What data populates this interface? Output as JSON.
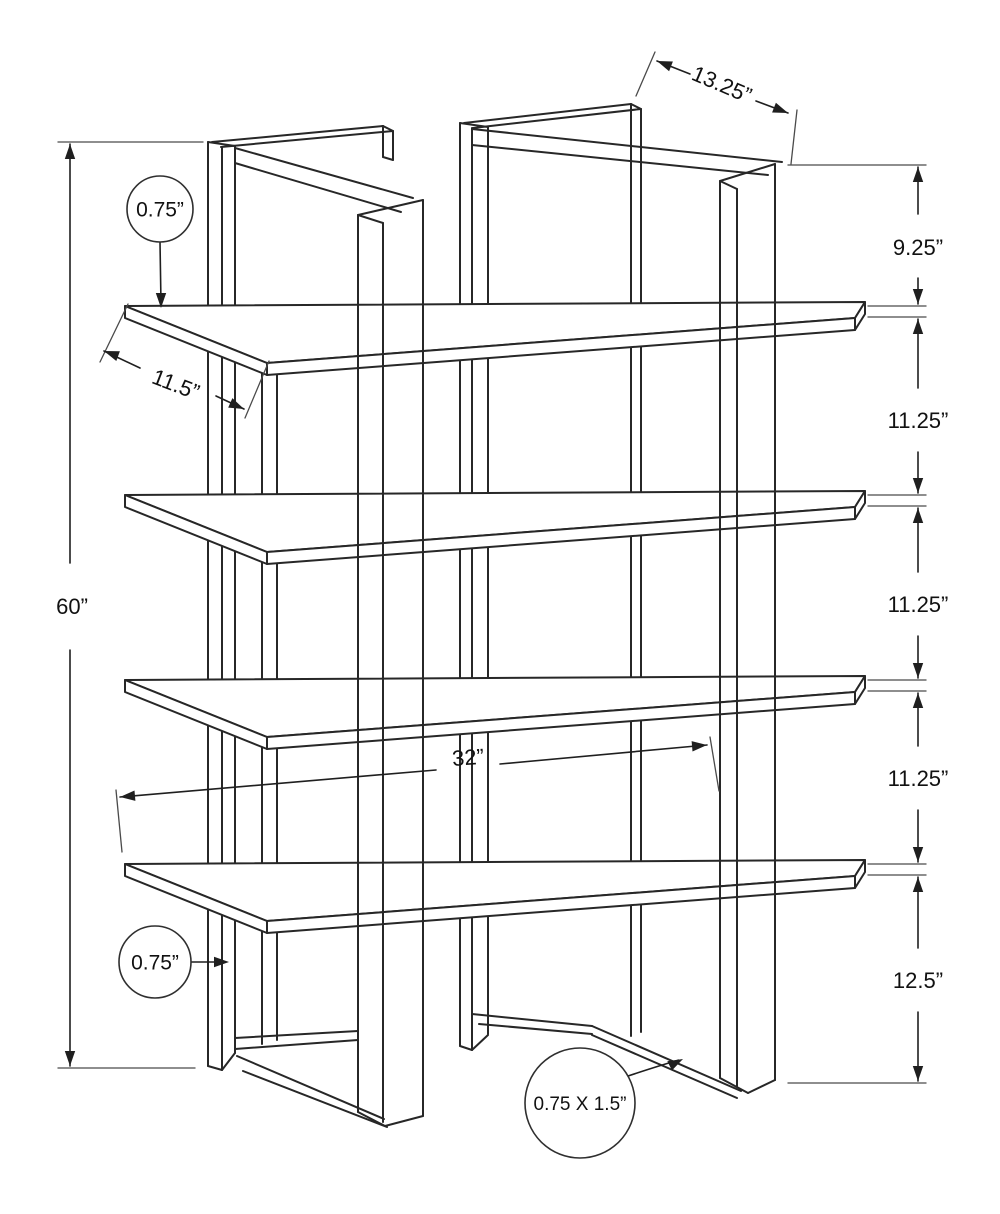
{
  "title": "bookcase-dimension-diagram",
  "labels": {
    "height_total": "60”",
    "top_depth": "13.25”",
    "shelf_depth": "11.5”",
    "width": "32”",
    "gap_top": "9.25”",
    "gap_mid": "11.25”",
    "gap_bottom": "12.5”",
    "shelf_thickness": "0.75”",
    "frame_thickness": "0.75”",
    "tube_size": "0.75 X 1.5”"
  },
  "dimensions_summary": {
    "overall_height": "60”",
    "top_frame_depth": "13.25”",
    "shelf_depth": "11.5”",
    "overall_width": "32”",
    "top_gap": "9.25”",
    "middle_gaps": [
      "11.25”",
      "11.25”",
      "11.25”"
    ],
    "bottom_gap": "12.5”",
    "shelf_thickness": "0.75”",
    "frame_thickness": "0.75”",
    "frame_tube_section": "0.75 X 1.5”"
  },
  "style": {
    "bg": "#ffffff",
    "structure_color": "#272727",
    "dim_color": "#1f1f1f",
    "ext_color": "#4a4a4a",
    "structure_width": 2,
    "dim_width": 1.6,
    "ext_width": 1.3,
    "circle_width": 1.6
  },
  "drawing": {
    "canvas": {
      "w": 1000,
      "h": 1214
    },
    "shelves": {
      "tops": [
        306,
        495,
        680,
        864
      ],
      "x_left": 125,
      "x_right": 865,
      "x_front_left": 267,
      "x_front_right": 855,
      "back_rise": 4,
      "front_left_dy": 57,
      "front_right_dy": 12,
      "thickness_dy": 12
    },
    "far_lines": [
      [
        "left-back-post-outer",
        208,
        142,
        208,
        1066
      ],
      [
        "left-back-post-mid",
        222,
        147,
        222,
        1070
      ],
      [
        "left-back-post-inner",
        235,
        146,
        235,
        1053
      ],
      [
        "left-back-post-topcap",
        208,
        142,
        235,
        146
      ],
      [
        "left-back-post-botcap-a",
        208,
        1066,
        222,
        1070
      ],
      [
        "left-back-post-botcap-b",
        222,
        1070,
        235,
        1053
      ],
      [
        "left-top-band-outer",
        212,
        142,
        383,
        126
      ],
      [
        "left-top-band-inner",
        221,
        147,
        393,
        131
      ],
      [
        "left-top-band-endcap",
        383,
        126,
        393,
        131
      ],
      [
        "left-top-stub-a",
        383,
        126,
        383,
        157
      ],
      [
        "left-top-stub-b",
        393,
        131,
        393,
        160
      ],
      [
        "left-top-stub-bot",
        383,
        157,
        393,
        160
      ],
      [
        "left-mid-bar-a",
        262,
        366,
        262,
        1044
      ],
      [
        "left-mid-bar-b",
        277,
        364,
        277,
        1040
      ],
      [
        "right-back-post-outer",
        460,
        123,
        460,
        1046
      ],
      [
        "right-back-post-mid",
        472,
        128,
        472,
        1050
      ],
      [
        "right-back-post-inner",
        488,
        127,
        488,
        1034
      ],
      [
        "right-back-post-topcap",
        460,
        123,
        488,
        127
      ],
      [
        "right-back-post-botcap-a",
        460,
        1046,
        472,
        1050
      ],
      [
        "right-back-post-botcap-b",
        472,
        1050,
        488,
        1035
      ],
      [
        "right-top-band-outer",
        464,
        123,
        631,
        104
      ],
      [
        "right-top-band-inner",
        473,
        128,
        641,
        109
      ],
      [
        "right-top-band-endcap",
        631,
        104,
        641,
        109
      ],
      [
        "right-stub-bar-a",
        631,
        104,
        631,
        1036
      ],
      [
        "right-stub-bar-b",
        641,
        109,
        641,
        1032
      ]
    ],
    "near_lines": [
      [
        "left-top-rail-top",
        235,
        148,
        413,
        198
      ],
      [
        "left-top-rail-bottom",
        235,
        163,
        401,
        212
      ],
      [
        "left-front-post-outer",
        358,
        215,
        358,
        1112
      ],
      [
        "left-front-post-mid",
        383,
        223,
        383,
        1122
      ],
      [
        "left-front-post-inner",
        423,
        200,
        423,
        1116
      ],
      [
        "left-front-post-topcap-a",
        358,
        215,
        423,
        200
      ],
      [
        "left-front-post-topcap-b",
        358,
        215,
        383,
        223
      ],
      [
        "left-front-post-botcap-a",
        358,
        1112,
        385,
        1126
      ],
      [
        "left-front-post-botcap-b",
        385,
        1126,
        423,
        1116
      ],
      [
        "left-bottom-rail-far-a",
        235,
        1038,
        358,
        1031
      ],
      [
        "left-bottom-rail-far-b",
        235,
        1049,
        358,
        1040
      ],
      [
        "left-bottom-rail-near-a",
        237,
        1056,
        384,
        1119
      ],
      [
        "left-bottom-rail-near-b",
        243,
        1071,
        387,
        1127
      ],
      [
        "right-top-rail-top",
        472,
        129,
        782,
        162
      ],
      [
        "right-top-rail-bottom",
        472,
        145,
        768,
        175
      ],
      [
        "right-front-post-outer",
        720,
        181,
        720,
        1078
      ],
      [
        "right-front-post-mid",
        737,
        189,
        737,
        1087
      ],
      [
        "right-front-post-inner",
        775,
        164,
        775,
        1080
      ],
      [
        "right-front-post-topcap-a",
        720,
        181,
        775,
        164
      ],
      [
        "right-front-post-topcap-b",
        720,
        181,
        737,
        189
      ],
      [
        "right-front-post-botcap-a",
        720,
        1078,
        748,
        1093
      ],
      [
        "right-front-post-botcap-b",
        748,
        1093,
        775,
        1080
      ],
      [
        "right-bottom-rail-far-a",
        472,
        1014,
        592,
        1026
      ],
      [
        "right-bottom-rail-far-b",
        479,
        1024,
        592,
        1034
      ],
      [
        "right-bottom-rail-near-a",
        592,
        1026,
        741,
        1091
      ],
      [
        "right-bottom-rail-near-b",
        592,
        1035,
        737,
        1098
      ]
    ],
    "ext_lines": [
      [
        "ext-height-top",
        58,
        142,
        203,
        142
      ],
      [
        "ext-height-bottom",
        58,
        1068,
        195,
        1068
      ],
      [
        "ext-right-top",
        788,
        165,
        926,
        165
      ],
      [
        "ext-shelf1-top",
        868,
        306,
        926,
        306
      ],
      [
        "ext-shelf1-bottom",
        868,
        317,
        926,
        317
      ],
      [
        "ext-shelf2-top",
        868,
        495,
        926,
        495
      ],
      [
        "ext-shelf2-bottom",
        868,
        506,
        926,
        506
      ],
      [
        "ext-shelf3-top",
        868,
        680,
        926,
        680
      ],
      [
        "ext-shelf3-bottom",
        868,
        691,
        926,
        691
      ],
      [
        "ext-shelf4-top",
        868,
        864,
        926,
        864
      ],
      [
        "ext-shelf4-bottom",
        868,
        875,
        926,
        875
      ],
      [
        "ext-floor",
        788,
        1083,
        926,
        1083
      ],
      [
        "ext-depth-left",
        655,
        52,
        636,
        96
      ],
      [
        "ext-depth-right",
        797,
        110,
        791,
        164
      ],
      [
        "ext-shelfdepth-back",
        128,
        304,
        100,
        362
      ],
      [
        "ext-shelfdepth-front",
        269,
        361,
        245,
        418
      ],
      [
        "ext-width-left",
        116,
        790,
        122,
        852
      ],
      [
        "ext-width-right",
        710,
        737,
        719,
        791
      ]
    ],
    "dim_segments": [
      [
        "dim-height-a",
        70,
        144,
        70,
        563
      ],
      [
        "dim-height-b",
        70,
        650,
        70,
        1066
      ],
      [
        "dim-depth-a",
        657,
        61,
        690,
        74
      ],
      [
        "dim-depth-b",
        756,
        101,
        788,
        113
      ],
      [
        "dim-shelfdepth-a",
        104,
        351,
        140,
        368
      ],
      [
        "dim-shelfdepth-b",
        216,
        396,
        244,
        409
      ],
      [
        "dim-width-a",
        120,
        797,
        436,
        770
      ],
      [
        "dim-width-b",
        500,
        764,
        707,
        745
      ],
      [
        "dim-right1-a",
        918,
        167,
        918,
        214
      ],
      [
        "dim-right1-b",
        918,
        278,
        918,
        304
      ],
      [
        "dim-right2-a",
        918,
        319,
        918,
        388
      ],
      [
        "dim-right2-b",
        918,
        452,
        918,
        493
      ],
      [
        "dim-right3-a",
        918,
        508,
        918,
        572
      ],
      [
        "dim-right3-b",
        918,
        636,
        918,
        678
      ],
      [
        "dim-right4-a",
        918,
        693,
        918,
        746
      ],
      [
        "dim-right4-b",
        918,
        810,
        918,
        862
      ],
      [
        "dim-right5-a",
        918,
        877,
        918,
        948
      ],
      [
        "dim-right5-b",
        918,
        1012,
        918,
        1081
      ],
      [
        "leader-shelf-thickness",
        160,
        242,
        161,
        304
      ],
      [
        "leader-frame-thickness",
        191,
        962,
        225,
        962
      ]
    ],
    "leader_paths": [
      [
        "leader-tube-size",
        "M628,1076 Q658,1066 679,1060"
      ]
    ],
    "arrows": [
      [
        918,
        167,
        -90
      ],
      [
        918,
        304,
        90
      ],
      [
        918,
        319,
        -90
      ],
      [
        918,
        493,
        90
      ],
      [
        918,
        508,
        -90
      ],
      [
        918,
        678,
        90
      ],
      [
        918,
        693,
        -90
      ],
      [
        918,
        862,
        90
      ],
      [
        918,
        877,
        -90
      ],
      [
        918,
        1081,
        90
      ],
      [
        70,
        144,
        -90
      ],
      [
        70,
        1066,
        90
      ],
      [
        657,
        61,
        201
      ],
      [
        788,
        113,
        21
      ],
      [
        104,
        351,
        200
      ],
      [
        244,
        409,
        24
      ],
      [
        120,
        797,
        175
      ],
      [
        707,
        745,
        -5
      ],
      [
        161,
        308,
        90
      ],
      [
        229,
        962,
        0
      ],
      [
        683,
        1059,
        -27
      ]
    ],
    "circles": [
      [
        "callout-circle-shelf-thickness",
        160,
        209,
        33
      ],
      [
        "callout-circle-frame-thickness",
        155,
        962,
        36
      ],
      [
        "callout-circle-tube-size",
        580,
        1103,
        55
      ]
    ],
    "texts": [
      [
        "dim-label-gap-top",
        "labels.gap_top",
        918,
        247,
        0,
        22
      ],
      [
        "dim-label-gap-2",
        "labels.gap_mid",
        918,
        420,
        0,
        22
      ],
      [
        "dim-label-gap-3",
        "labels.gap_mid",
        918,
        604,
        0,
        22
      ],
      [
        "dim-label-gap-4",
        "labels.gap_mid",
        918,
        778,
        0,
        22
      ],
      [
        "dim-label-gap-bottom",
        "labels.gap_bottom",
        918,
        980,
        0,
        22
      ],
      [
        "dim-label-height",
        "labels.height_total",
        72,
        606,
        0,
        22
      ],
      [
        "dim-label-top-depth",
        "labels.top_depth",
        722,
        84,
        23,
        22
      ],
      [
        "dim-label-shelf-depth",
        "labels.shelf_depth",
        176,
        384,
        21,
        22
      ],
      [
        "dim-label-width",
        "labels.width",
        468,
        757,
        -4,
        22
      ],
      [
        "callout-label-shelf-thickness",
        "labels.shelf_thickness",
        160,
        209,
        0,
        21
      ],
      [
        "callout-label-frame-thickness",
        "labels.frame_thickness",
        155,
        962,
        0,
        21
      ],
      [
        "callout-label-tube-size",
        "labels.tube_size",
        580,
        1103,
        0,
        19
      ]
    ]
  }
}
